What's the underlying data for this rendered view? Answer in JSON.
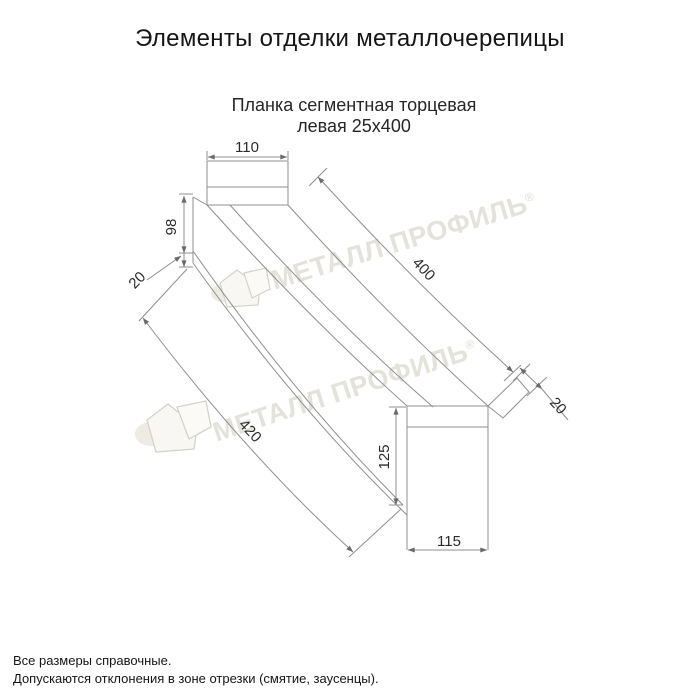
{
  "page": {
    "title": "Элементы отделки металлочерепицы"
  },
  "product": {
    "name_line1": "Планка сегментная торцевая",
    "name_line2": "левая 25x400"
  },
  "dims": {
    "top_width": "110",
    "left_height": "98",
    "left_fold": "20",
    "top_edge_length": "400",
    "bottom_edge_length": "420",
    "right_fold": "20",
    "right_height": "125",
    "bottom_width": "115"
  },
  "watermark": {
    "brand": "МЕТАЛЛ ПРОФИЛЬ",
    "registered": "®"
  },
  "notes": {
    "line1": "Все размеры справочные.",
    "line2": "Допускаются отклонения в зоне отрезки (смятие, заусенцы)."
  },
  "colors": {
    "line": "#8f8f8f",
    "dim_text": "#2b2b2b",
    "watermark": "#e3e2db"
  }
}
